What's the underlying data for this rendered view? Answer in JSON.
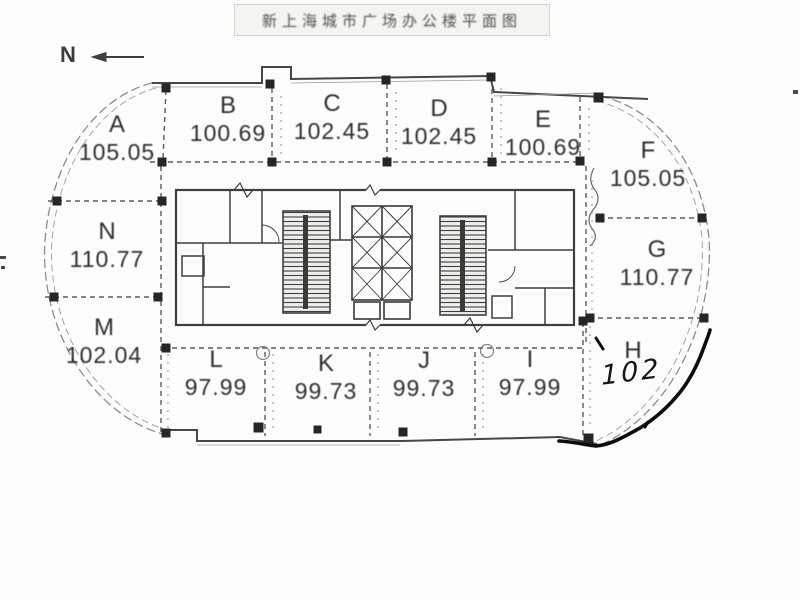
{
  "title": {
    "text": "新上海城市广场办公楼平面图"
  },
  "compass": {
    "label": "N",
    "arrow_icon": "left-arrow"
  },
  "units": {
    "A": {
      "label": "A",
      "area": "105.05"
    },
    "B": {
      "label": "B",
      "area": "100.69"
    },
    "C": {
      "label": "C",
      "area": "102.45"
    },
    "D": {
      "label": "D",
      "area": "102.45"
    },
    "E": {
      "label": "E",
      "area": "100.69"
    },
    "F": {
      "label": "F",
      "area": "105.05"
    },
    "G": {
      "label": "G",
      "area": "110.77"
    },
    "H": {
      "label": "H",
      "area_note": "102"
    },
    "I": {
      "label": "I",
      "area": "97.99"
    },
    "J": {
      "label": "J",
      "area": "99.73"
    },
    "K": {
      "label": "K",
      "area": "99.73"
    },
    "L": {
      "label": "L",
      "area": "97.99"
    },
    "M": {
      "label": "M",
      "area": "102.04"
    },
    "N": {
      "label": "N",
      "area": "110.77"
    }
  },
  "colors": {
    "ink": "#3e3e3e",
    "wall": "#474747",
    "column": "#262626",
    "pen_annotation": "#0d0d0d",
    "paper": "#fdfdfc"
  }
}
